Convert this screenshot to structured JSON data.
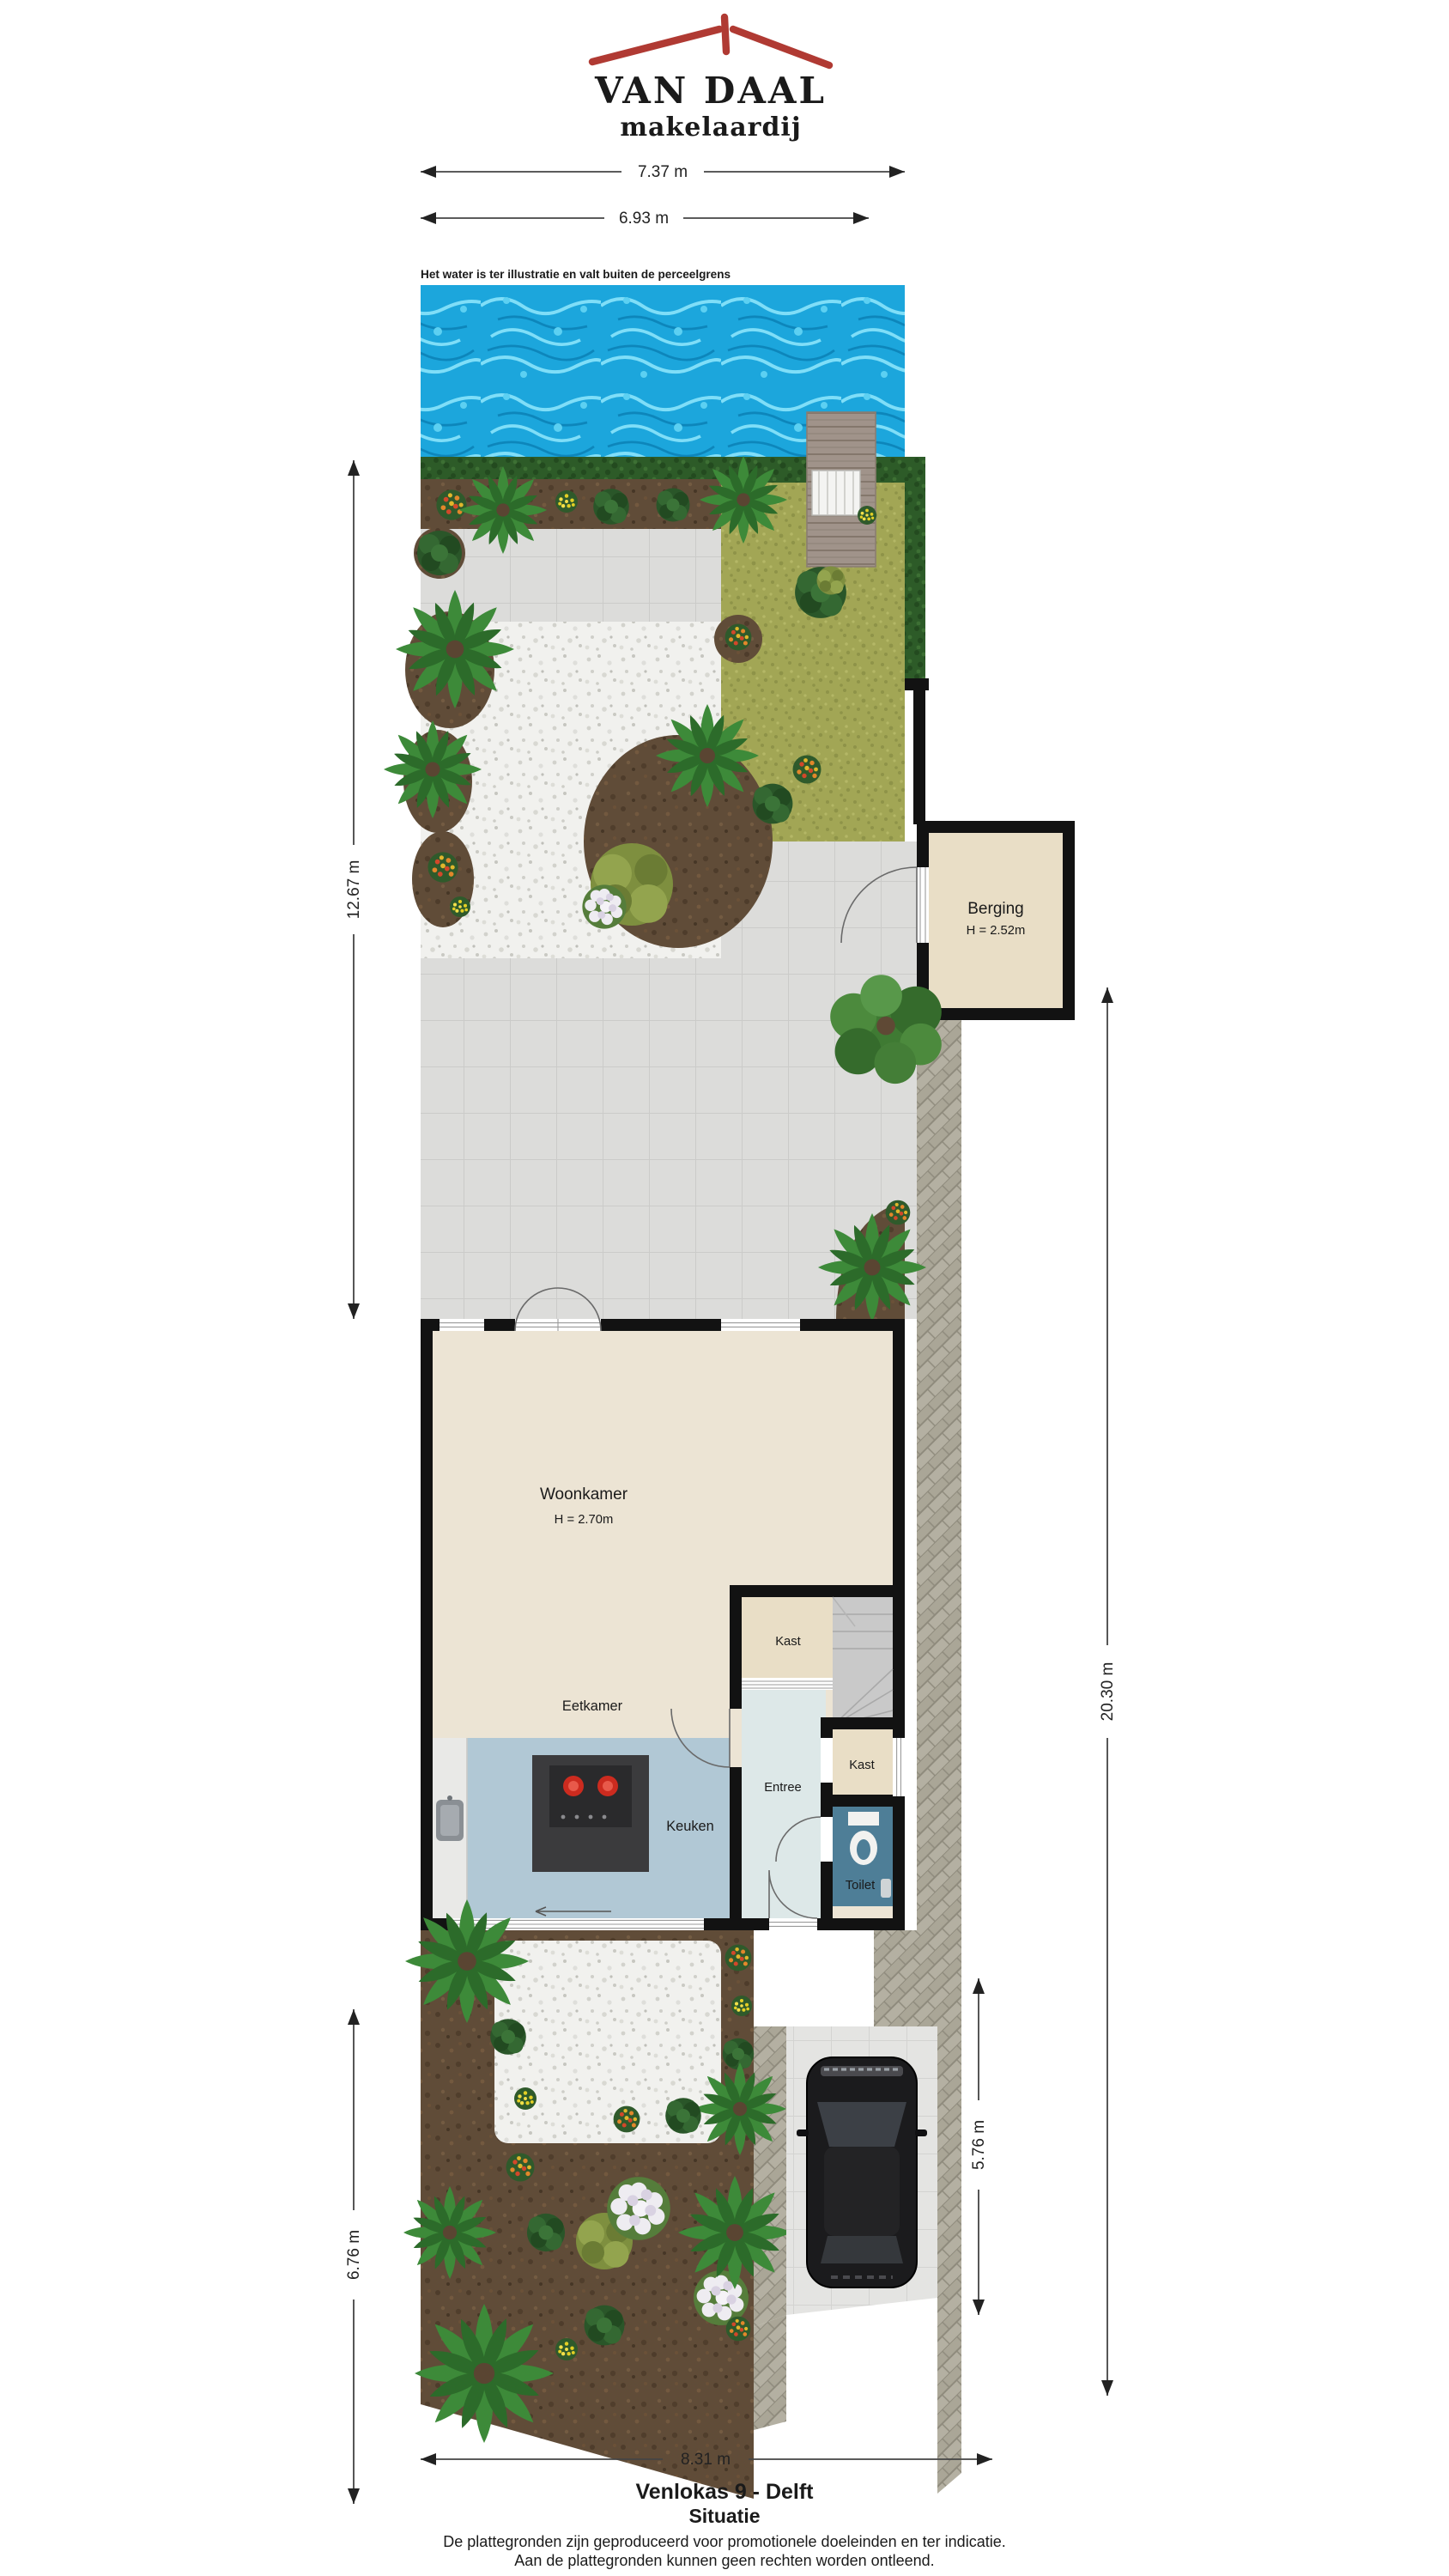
{
  "logo": {
    "title": "VAN DAAL",
    "subtitle": "makelaardij"
  },
  "water_note": "Het water is ter illustratie en valt buiten de perceelgrens",
  "dimensions": {
    "top_outer": "7.37 m",
    "top_inner": "6.93 m",
    "garden_left": "12.67 m",
    "plot_right": "20.30 m",
    "front_left": "6.76 m",
    "parking_right": "5.76 m",
    "bottom": "8.31 m"
  },
  "rooms": {
    "berging": {
      "name": "Berging",
      "height": "H = 2.52m"
    },
    "woonkamer": {
      "name": "Woonkamer",
      "height": "H = 2.70m"
    },
    "eetkamer": {
      "name": "Eetkamer"
    },
    "kast_upper": {
      "name": "Kast"
    },
    "kast_lower": {
      "name": "Kast"
    },
    "entree": {
      "name": "Entree"
    },
    "keuken": {
      "name": "Keuken"
    },
    "toilet": {
      "name": "Toilet"
    }
  },
  "footer": {
    "title": "Venlokas 9 - Delft",
    "subtitle": "Situatie",
    "disclaimer1": "De plattegronden zijn geproduceerd voor promotionele doeleinden en ter indicatie.",
    "disclaimer2": "Aan de plattegronden kunnen geen rechten worden ontleend."
  },
  "palette": {
    "logo_navy": "#21407c",
    "logo_red": "#b03a33",
    "wall_black": "#121212",
    "floor_cream": "#ece4d4",
    "floor_beige": "#e9dec6",
    "floor_kitchen": "#b1c8d5",
    "floor_entree": "#dde8e8",
    "floor_toilet": "#4e7e97",
    "water_blue": "#1ca6dc",
    "grass_green": "#a2a655",
    "hedge_green": "#2d5b28",
    "soil_brown": "#604c38",
    "herringbone_gray": "#b4b0a2"
  }
}
